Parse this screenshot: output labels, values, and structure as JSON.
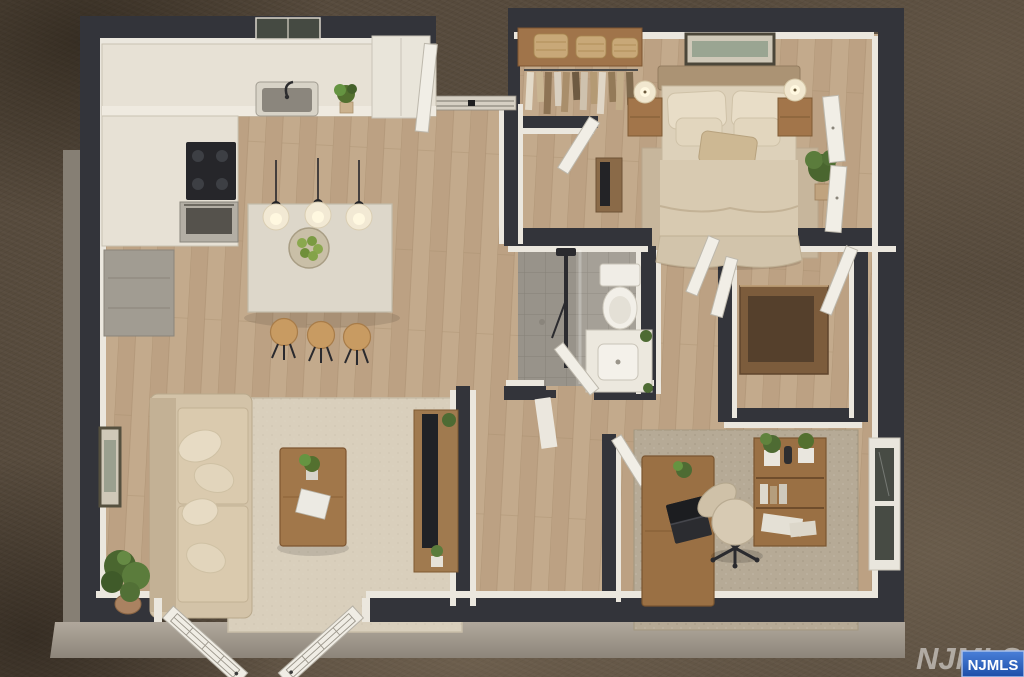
{
  "image": {
    "kind": "3d-rendered-floor-plan",
    "view": "aerial-dollhouse",
    "style": "virtually-staged-real-estate-render"
  },
  "watermark": {
    "large_text": "NJMLS",
    "badge_text": "NJMLS",
    "badge_fill": "#2a5abe",
    "badge_border": "#a9c0ea",
    "badge_text_color": "#ffffff",
    "large_text_color": "rgba(255,255,255,0.5)"
  },
  "palette": {
    "background_carpet": "#564a3c",
    "wall_top": "#33343a",
    "wall_face": "#ebe7de",
    "wood_floor": "#c3aa8c",
    "tile_floor": "#a5a097",
    "exterior_concrete": "#a59d92",
    "rug_living": "#d9cfbc",
    "rug_bedroom": "#c7b69c",
    "rug_office": "#b6aa96",
    "wood_furniture": "#9c7347",
    "marble_counter": "#e7e1d5",
    "sofa": "#d3c3a8",
    "bedding": "#d8cab1",
    "plant_green": "#53702f",
    "door_white": "#f1eee6"
  },
  "rooms": [
    {
      "name": "kitchen",
      "position": "top-left",
      "items": [
        "l-shaped-marble-counter",
        "sink",
        "window-over-sink",
        "cooktop",
        "oven",
        "pantry-cabinet",
        "kitchen-island",
        "fruit-bowl-with-green-apples",
        "bar-stools",
        "pendant-lights",
        "counter-plant"
      ],
      "bar_stool_count": 3,
      "pendant_light_count": 3
    },
    {
      "name": "living-room",
      "position": "bottom-left",
      "items": [
        "sofa",
        "throw-pillows",
        "coffee-table",
        "potted-plant-on-table",
        "book",
        "area-rug",
        "tv-console",
        "tv",
        "floor-plant",
        "wall-art",
        "french-doors"
      ],
      "french_door_count": 2
    },
    {
      "name": "bedroom",
      "position": "top-right",
      "items": [
        "double-bed",
        "headboard",
        "pillows",
        "nightstands",
        "table-lamps",
        "wall-art",
        "area-rug",
        "closet-shelf-with-baskets",
        "hanging-clothes",
        "closet-doors",
        "tv-stand",
        "plant"
      ],
      "nightstand_count": 2,
      "lamp_count": 2,
      "basket_count": 3
    },
    {
      "name": "bathroom",
      "position": "center",
      "items": [
        "walk-in-shower",
        "shower-fixture",
        "toilet",
        "vanity-sink",
        "small-plants"
      ]
    },
    {
      "name": "home-office",
      "position": "bottom-right",
      "items": [
        "desk",
        "laptop",
        "office-chair",
        "bookshelf",
        "plants",
        "area-rug",
        "window"
      ]
    },
    {
      "name": "walk-in-closet",
      "position": "middle-right",
      "items": [
        "built-in-wardrobe",
        "doors"
      ]
    },
    {
      "name": "entry",
      "position": "top-center",
      "items": [
        "front-door",
        "threshold"
      ]
    },
    {
      "name": "hallway",
      "position": "center-bottom",
      "items": [
        "interior-doors"
      ]
    }
  ]
}
